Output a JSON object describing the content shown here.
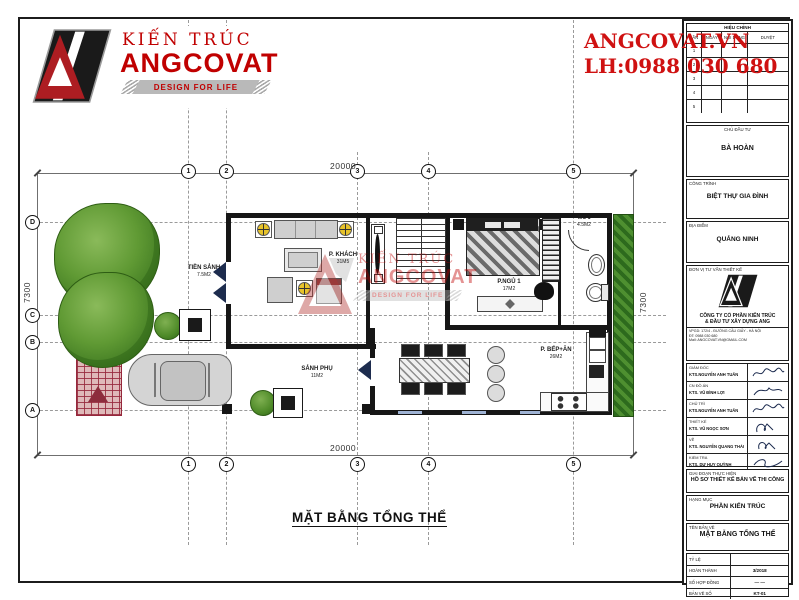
{
  "brand": {
    "name_line1": "KIẾN TRÚC",
    "name_line2": "ANGCOVAT",
    "tagline": "DESIGN FOR LIFE",
    "website": "ANGCOVAT.VN",
    "phone": "LH:0988 030 680",
    "accent_red": "#c00000"
  },
  "titleblock": {
    "revision": {
      "title": "HIỆU CHỈNH",
      "columns": [
        "LẦN",
        "NGÀY",
        "NỘI DUNG",
        "DUYỆT"
      ],
      "rows": [
        "1",
        "2",
        "3",
        "4",
        "5"
      ]
    },
    "owner_label": "CHỦ ĐẦU TƯ",
    "owner": "BÀ HOÀN",
    "project_label": "CÔNG TRÌNH",
    "project": "BIỆT THỰ GIA ĐÌNH",
    "location_label": "ĐỊA ĐIỂM",
    "location": "QUẢNG NINH",
    "consultant_label": "ĐƠN VỊ TƯ VẤN THIẾT KẾ",
    "company_line1": "CÔNG TY CỔ PHẦN KIẾN TRÚC",
    "company_line2": "& ĐẦU TƯ XÂY DỰNG ANG",
    "address_lines": [
      "VPGD: 172/4 - ĐƯỜNG CẦU GIẤY - HÀ NỘI",
      "ĐT: 0988 030 680",
      "Mail: ANGCOVAT.VN@GMAIL.COM"
    ],
    "signatures": [
      {
        "role": "GIÁM ĐỐC",
        "name": "KTS.NGUYỄN ANH TUẤN"
      },
      {
        "role": "CN ĐỒ ÁN",
        "name": "KTS. VŨ ĐÌNH LỢI"
      },
      {
        "role": "CHỦ TRÌ",
        "name": "KTS.NGUYỄN ANH TUẤN"
      },
      {
        "role": "THIẾT KẾ",
        "name": "KTS. VŨ NGỌC SƠN"
      },
      {
        "role": "VẼ",
        "name": "KTS. NGUYỄN QUANG THÁI"
      },
      {
        "role": "KIỂM TRA",
        "name": "KTS. DƯ HUY QUỲNH"
      }
    ],
    "phase_label": "GIAI ĐOẠN THỰC HIỆN",
    "phase": "HỒ SƠ THIẾT KẾ BẢN VẼ THI CÔNG",
    "category_label": "HẠNG MỤC",
    "category": "PHẦN KIẾN TRÚC",
    "drawing_label": "TÊN BẢN VẼ",
    "drawing": "MẶT BẰNG TỔNG THỂ",
    "meta": [
      {
        "label": "TỶ LỆ",
        "value": ""
      },
      {
        "label": "HOÀN THÀNH",
        "value": "3/2018"
      },
      {
        "label": "SỐ HỢP ĐỒNG",
        "value": "—  —"
      },
      {
        "label": "BẢN VẼ SỐ",
        "value": "KT-01"
      }
    ]
  },
  "plan": {
    "title": "MẶT BẰNG TỔNG THỂ",
    "dims": {
      "top": "20000",
      "bottom": "20000",
      "left": "7300",
      "right": "7300"
    },
    "grid_cols": [
      "1",
      "2",
      "3",
      "4",
      "5"
    ],
    "grid_rows": [
      "D",
      "C",
      "B",
      "A"
    ],
    "rooms": [
      {
        "name": "P. KHÁCH",
        "area": "31M5"
      },
      {
        "name": "P.NGỦ 1",
        "area": "17M2"
      },
      {
        "name": "WC 1",
        "area": "4.5M2"
      },
      {
        "name": "P. BẾP+ĂN",
        "area": "26M2"
      },
      {
        "name": "SẢNH PHỤ",
        "area": "11M2"
      },
      {
        "name": "TIỀN SẢNH",
        "area": "7.5M2"
      }
    ]
  }
}
